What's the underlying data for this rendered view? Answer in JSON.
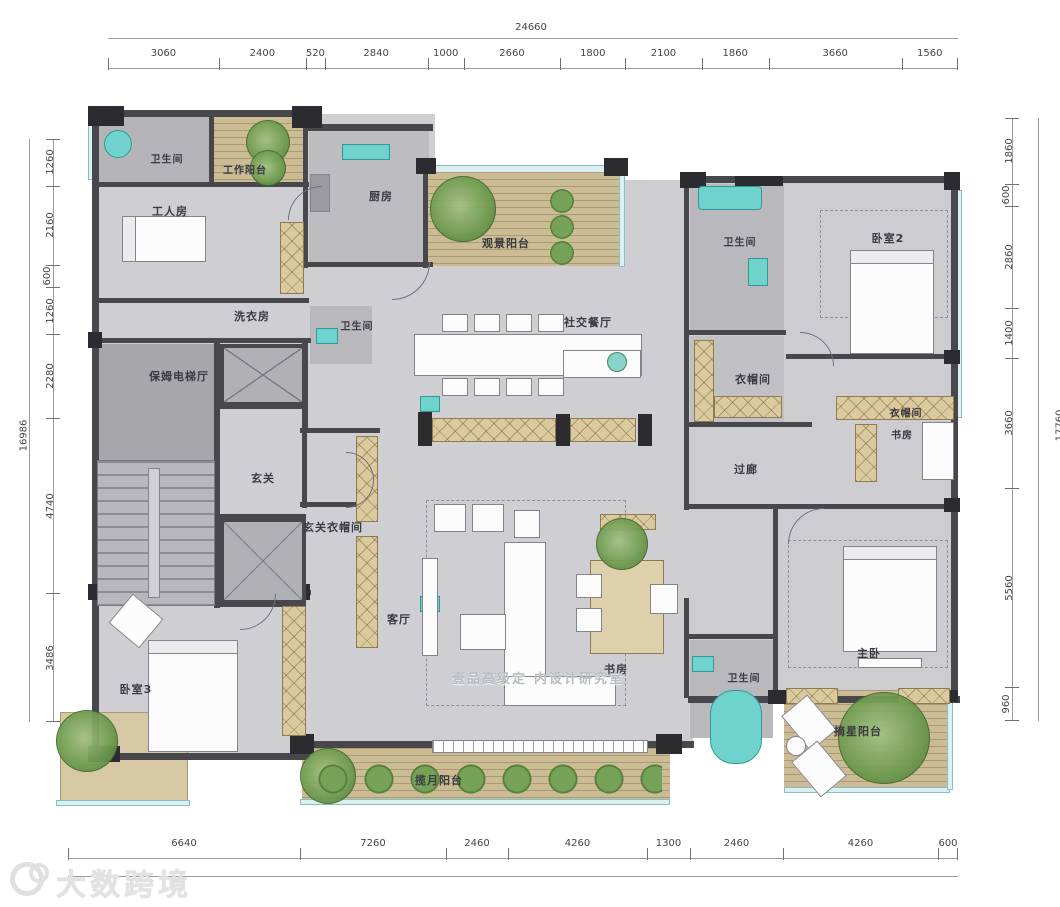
{
  "title": "residential-floor-plan",
  "rooms": {
    "bath_tl": "卫生间",
    "work_balcony": "工作阳台",
    "kitchen": "厨房",
    "view_balcony": "观景阳台",
    "worker_room": "工人房",
    "laundry": "洗衣房",
    "bath_small": "卫生间",
    "social_dining": "社交餐厅",
    "bath_tr": "卫生间",
    "bedroom2": "卧室2",
    "cloak_1": "衣帽间",
    "cloak_2": "衣帽间",
    "study_right": "书房",
    "corridor": "过廊",
    "nanny_hall": "保姆电梯厅",
    "foyer": "玄关",
    "foyer_cloak": "玄关衣帽间",
    "living": "客厅",
    "study_center": "书房",
    "bath_center": "卫生间",
    "master": "主卧",
    "bedroom3": "卧室3",
    "moon_balcony": "揽月阳台",
    "star_balcony": "摘星阳台"
  },
  "dimensions": {
    "top": {
      "total": "24660",
      "segments": [
        "3060",
        "2400",
        "520",
        "2840",
        "1000",
        "2660",
        "1800",
        "2100",
        "1860",
        "3660",
        "1560"
      ]
    },
    "left": {
      "total": "16986",
      "segments": [
        "1260",
        "2160",
        "600",
        "1260",
        "2280",
        "4740",
        "3486"
      ]
    },
    "right": {
      "total": "17760",
      "segments": [
        "1860",
        "600",
        "2860",
        "1400",
        "3660",
        "5560",
        "960"
      ]
    },
    "bottom": {
      "segments": [
        "6640",
        "7260",
        "2460",
        "4260",
        "1300",
        "2460",
        "4260",
        "600"
      ]
    }
  },
  "watermark_center": {
    "part1": "壹品高级定",
    "part2": "内设计研究室"
  },
  "watermark_logo": {
    "text": "大数跨境"
  },
  "colors": {
    "wall": "#48484c",
    "floor": "#cfcfd3",
    "service_floor": "#b6b6ba",
    "cabinet_tan": "#dcca9f",
    "deck_wood": "#cbbc95",
    "fixture_teal": "#6fd2cd",
    "plant_green": "#6f9c50",
    "glass": "#dcf0f1"
  }
}
